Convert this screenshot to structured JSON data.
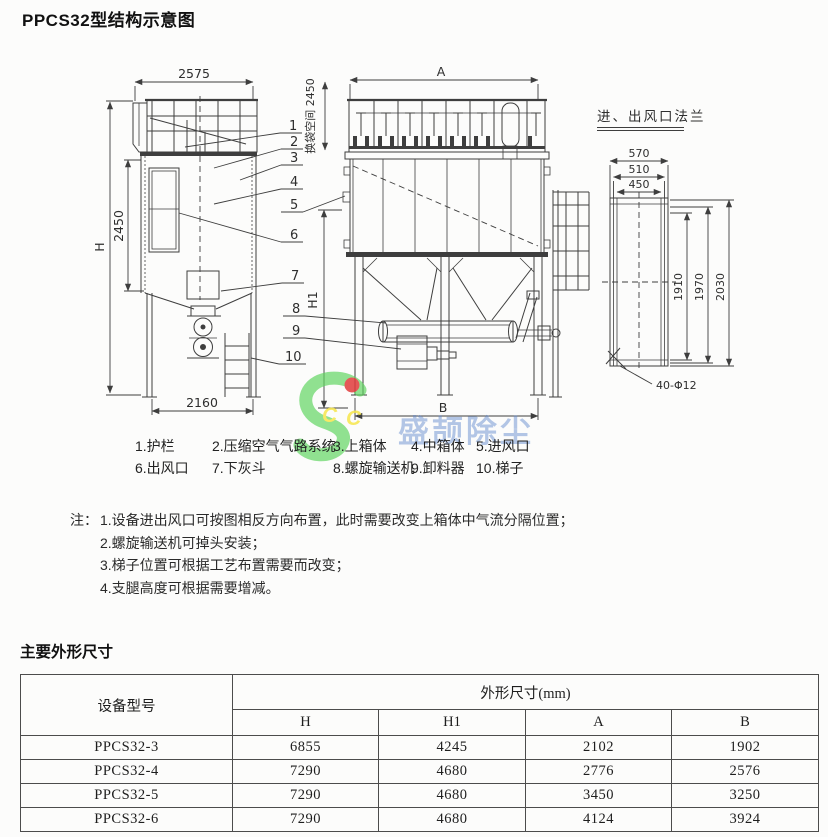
{
  "page": {
    "title": "PPCS32型结构示意图",
    "section_title": "主要外形尺寸"
  },
  "diagram": {
    "left_view": {
      "top_width": "2575",
      "body_height": "2450",
      "height_label": "H",
      "base_width": "2160"
    },
    "middle_view": {
      "top_width": "A",
      "bag_space": "换袋空间 2450",
      "support_height_label": "H1",
      "base_width": "B"
    },
    "flange_view": {
      "title": "进、出风口法兰",
      "width_outer": "570",
      "width_mid": "510",
      "width_inner": "450",
      "height_inner": "1910",
      "height_mid": "1970",
      "height_outer": "2030",
      "bolt_holes": "40-Φ12"
    },
    "leaders": [
      "1",
      "2",
      "3",
      "4",
      "5",
      "6",
      "7",
      "8",
      "9",
      "10"
    ],
    "watermark": {
      "text": "盛颉除尘",
      "monogram_left": "C",
      "monogram_right": "C",
      "green": "#5ed45e",
      "red": "#e23c3c",
      "yellow": "#f7e64b",
      "blue": "#5d86cc"
    }
  },
  "legend": {
    "row1": [
      "1.护栏",
      "2.压缩空气气路系统",
      "3.上箱体",
      "4.中箱体",
      "5.进风口"
    ],
    "row2": [
      "6.出风口",
      "7.下灰斗",
      "8.螺旋输送机",
      "9.卸料器",
      "10.梯子"
    ]
  },
  "notes": {
    "prefix": "注：",
    "items": [
      "1.设备进出风口可按图相反方向布置，此时需要改变上箱体中气流分隔位置；",
      "2.螺旋输送机可掉头安装；",
      "3.梯子位置可根据工艺布置需要而改变；",
      "4.支腿高度可根据需要增减。"
    ]
  },
  "spec_table": {
    "model_header": "设备型号",
    "dims_header": "外形尺寸(mm)",
    "sub_headers": [
      "H",
      "H1",
      "A",
      "B"
    ],
    "rows": [
      {
        "model": "PPCS32-3",
        "h": "6855",
        "h1": "4245",
        "a": "2102",
        "b": "1902"
      },
      {
        "model": "PPCS32-4",
        "h": "7290",
        "h1": "4680",
        "a": "2776",
        "b": "2576"
      },
      {
        "model": "PPCS32-5",
        "h": "7290",
        "h1": "4680",
        "a": "3450",
        "b": "3250"
      },
      {
        "model": "PPCS32-6",
        "h": "7290",
        "h1": "4680",
        "a": "4124",
        "b": "3924"
      }
    ]
  }
}
